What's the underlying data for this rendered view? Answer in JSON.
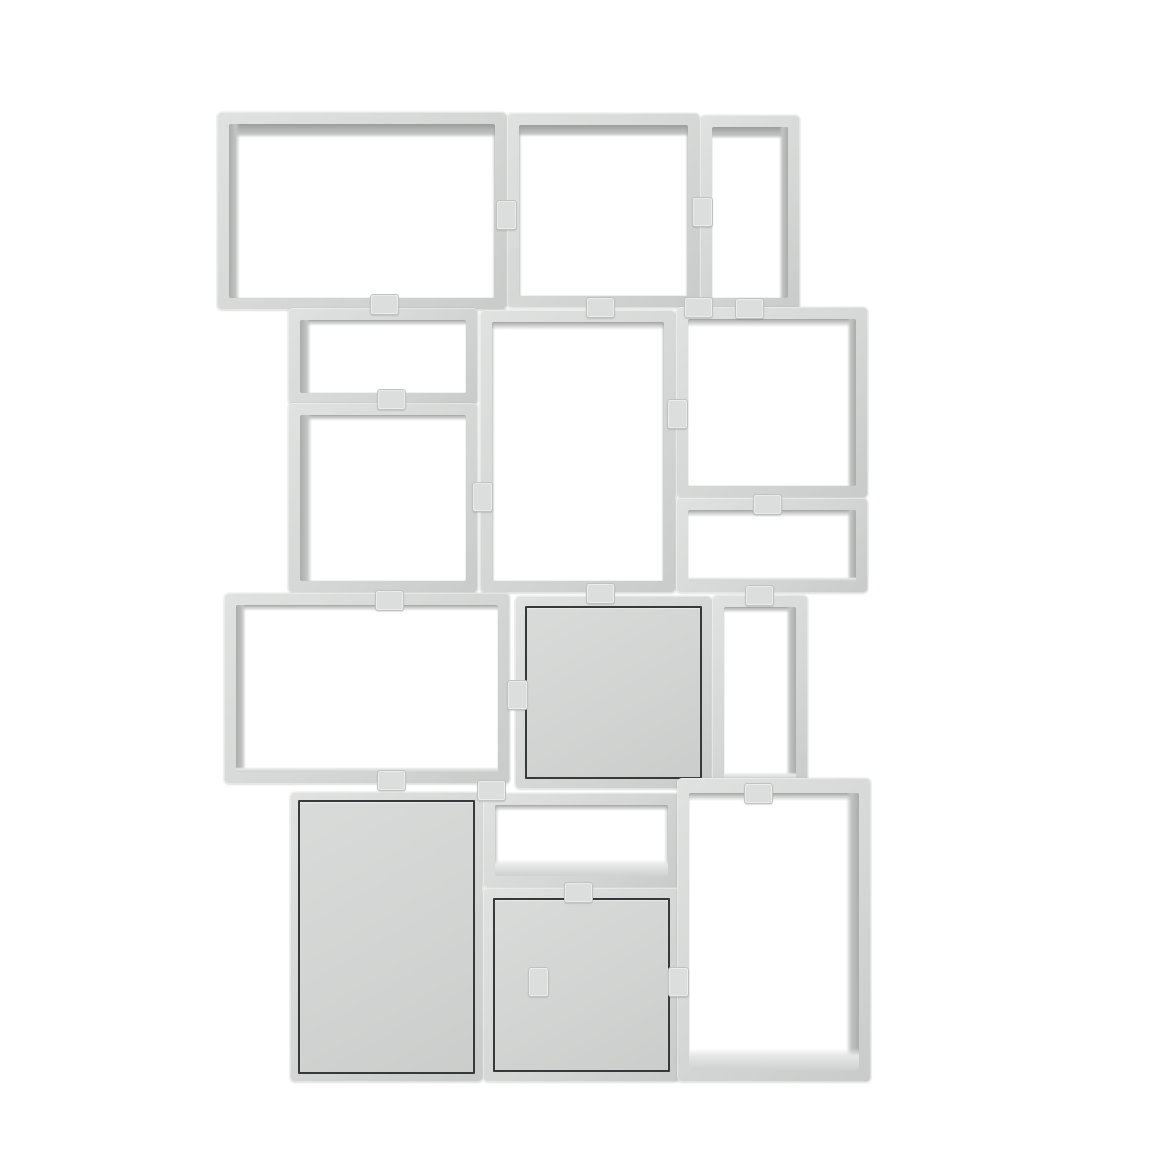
{
  "image": {
    "type": "product-render",
    "subject": "modular stacked shelving system of open grey cubes with three closed door modules",
    "background_color": "#ffffff",
    "canvas": {
      "width": 1160,
      "height": 1160
    }
  },
  "palette": {
    "frame": "#d5d7d6",
    "frame_light": "#e0e2e1",
    "frame_dark": "#c9cbca",
    "inner_shadow_dark": "#9b9d9c",
    "inner_shadow_mid": "#aaacab",
    "inner_shadow_soft": "#c2c4c3",
    "floor_light": "#cfd1d0",
    "floor_faint": "#e6e8e7",
    "door_fill_top": "#d9dbda",
    "door_fill_mid": "#d2d4d3",
    "door_fill_deep": "#cbcdcc",
    "door_border": "#35393a",
    "clip_fill": "#dcdedd",
    "clip_border": "#c0c2c1"
  },
  "frame_thickness": 12,
  "unit_bounds": {
    "left": 217,
    "top": 112,
    "right": 871,
    "bottom": 1082
  },
  "boxes": [
    {
      "id": "a",
      "x": 217,
      "y": 112,
      "w": 290,
      "h": 198,
      "type": "open",
      "shadow": {
        "top": 14,
        "top_style": "dark",
        "left": 11,
        "right": 3,
        "floor": 0
      }
    },
    {
      "id": "b",
      "x": 507,
      "y": 113,
      "w": 193,
      "h": 195,
      "type": "open",
      "shadow": {
        "top": 12,
        "top_style": "dark",
        "left": 3,
        "right": 3,
        "floor": 0
      }
    },
    {
      "id": "c",
      "x": 700,
      "y": 115,
      "w": 100,
      "h": 195,
      "type": "open",
      "shadow": {
        "top": 12,
        "top_style": "dark",
        "left": 0,
        "right": 9,
        "floor": 0
      }
    },
    {
      "id": "d",
      "x": 288,
      "y": 308,
      "w": 190,
      "h": 97,
      "type": "open",
      "shadow": {
        "top": 6,
        "top_style": "soft",
        "left": 11,
        "right": 0,
        "floor": 0
      }
    },
    {
      "id": "e",
      "x": 288,
      "y": 403,
      "w": 190,
      "h": 190,
      "type": "open",
      "shadow": {
        "top": 6,
        "top_style": "soft",
        "left": 12,
        "right": 0,
        "floor": 0
      }
    },
    {
      "id": "f",
      "x": 480,
      "y": 310,
      "w": 196,
      "h": 283,
      "type": "open",
      "shadow": {
        "top": 8,
        "top_style": "soft",
        "left": 3,
        "right": 3,
        "floor": 0
      }
    },
    {
      "id": "g",
      "x": 676,
      "y": 307,
      "w": 192,
      "h": 191,
      "type": "open",
      "shadow": {
        "top": 8,
        "top_style": "soft",
        "left": 0,
        "right": 9,
        "floor": 0
      }
    },
    {
      "id": "h",
      "x": 676,
      "y": 498,
      "w": 192,
      "h": 95,
      "type": "open",
      "shadow": {
        "top": 7,
        "top_style": "soft",
        "left": 0,
        "right": 9,
        "floor": 4
      }
    },
    {
      "id": "i",
      "x": 224,
      "y": 593,
      "w": 286,
      "h": 191,
      "type": "open",
      "shadow": {
        "top": 6,
        "top_style": "soft",
        "left": 10,
        "right": 0,
        "floor": 5
      }
    },
    {
      "id": "j",
      "x": 515,
      "y": 596,
      "w": 197,
      "h": 193,
      "type": "door",
      "door_inset": 10
    },
    {
      "id": "k",
      "x": 712,
      "y": 595,
      "w": 96,
      "h": 197,
      "type": "open",
      "shadow": {
        "top": 6,
        "top_style": "soft",
        "left": 0,
        "right": 10,
        "floor": 8
      }
    },
    {
      "id": "l",
      "x": 290,
      "y": 792,
      "w": 193,
      "h": 290,
      "type": "door",
      "door_inset": 8
    },
    {
      "id": "m",
      "x": 483,
      "y": 793,
      "w": 197,
      "h": 95,
      "type": "open",
      "shadow": {
        "top": 6,
        "top_style": "soft",
        "left": 4,
        "right": 4,
        "floor": 17
      }
    },
    {
      "id": "n",
      "x": 483,
      "y": 888,
      "w": 197,
      "h": 194,
      "type": "door",
      "door_inset": 10
    },
    {
      "id": "o",
      "x": 677,
      "y": 778,
      "w": 194,
      "h": 304,
      "type": "open",
      "top_frame": 15,
      "shadow": {
        "top": 8,
        "top_style": "soft",
        "left": 0,
        "right": 13,
        "floor": 22
      }
    }
  ],
  "clips": [
    {
      "x": 505,
      "y": 214,
      "orient": "v"
    },
    {
      "x": 701,
      "y": 211,
      "orient": "v"
    },
    {
      "x": 383,
      "y": 303,
      "orient": "h"
    },
    {
      "x": 599,
      "y": 306,
      "orient": "h"
    },
    {
      "x": 697,
      "y": 306,
      "orient": "h"
    },
    {
      "x": 748,
      "y": 307,
      "orient": "h"
    },
    {
      "x": 390,
      "y": 398,
      "orient": "h"
    },
    {
      "x": 481,
      "y": 496,
      "orient": "v"
    },
    {
      "x": 676,
      "y": 413,
      "orient": "v"
    },
    {
      "x": 766,
      "y": 503,
      "orient": "h"
    },
    {
      "x": 388,
      "y": 599,
      "orient": "h"
    },
    {
      "x": 599,
      "y": 592,
      "orient": "h"
    },
    {
      "x": 758,
      "y": 594,
      "orient": "h"
    },
    {
      "x": 516,
      "y": 694,
      "orient": "v"
    },
    {
      "x": 390,
      "y": 779,
      "orient": "h"
    },
    {
      "x": 490,
      "y": 789,
      "orient": "h"
    },
    {
      "x": 757,
      "y": 792,
      "orient": "h"
    },
    {
      "x": 577,
      "y": 891,
      "orient": "h"
    },
    {
      "x": 537,
      "y": 981,
      "orient": "v"
    },
    {
      "x": 677,
      "y": 981,
      "orient": "v"
    }
  ]
}
